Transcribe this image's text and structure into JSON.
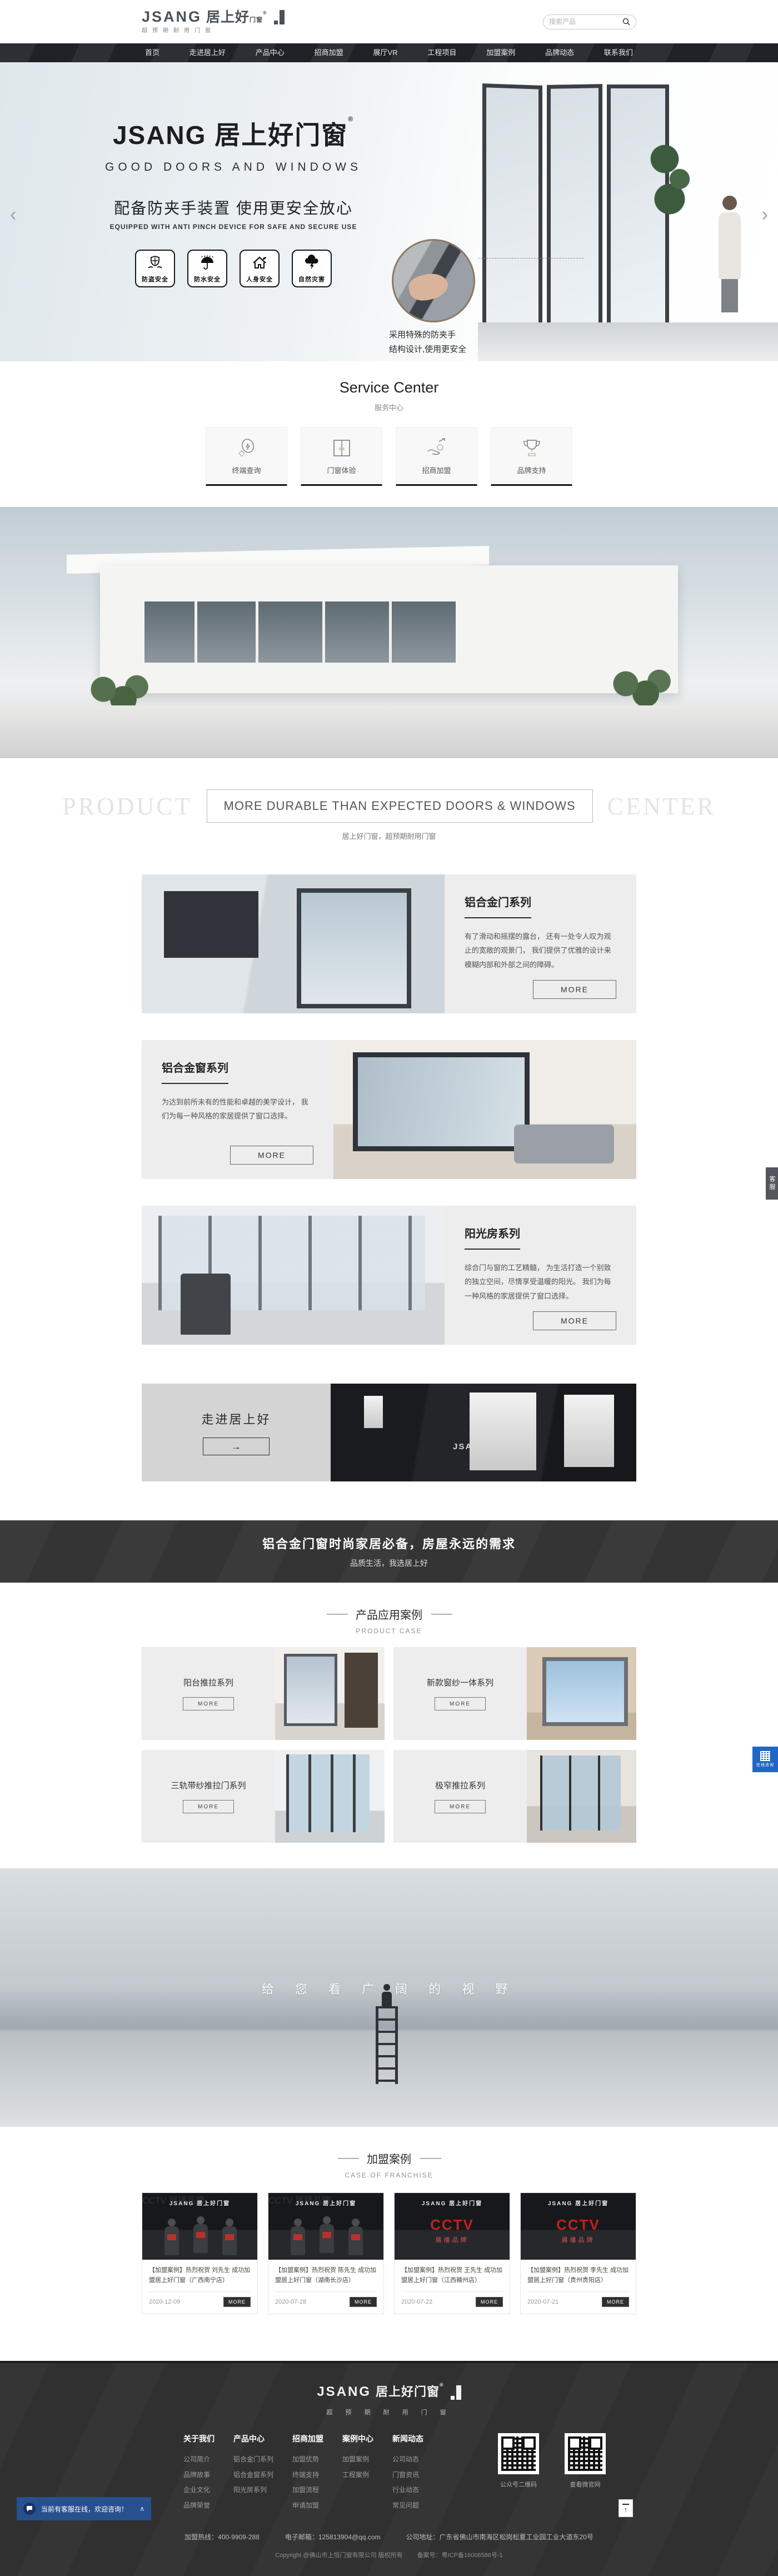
{
  "header": {
    "logo_en": "JSANG",
    "logo_cn": "居上好",
    "logo_suffix": "门窗",
    "logo_reg": "®",
    "tagline": "超预期耐用门窗",
    "search_placeholder": "搜索产品"
  },
  "nav": {
    "items": [
      "首页",
      "走进居上好",
      "产品中心",
      "招商加盟",
      "展厅VR",
      "工程项目",
      "加盟案例",
      "品牌动态",
      "联系我们"
    ]
  },
  "hero": {
    "title_en": "JSANG",
    "title_cn": "居上好门窗",
    "reg": "®",
    "subtitle": "GOOD DOORS AND WINDOWS",
    "slogan": "配备防夹手装置 使用更安全放心",
    "slogan_en": "EQUIPPED WITH ANTI PINCH DEVICE FOR SAFE AND SECURE USE",
    "badges": [
      {
        "label": "防盗安全"
      },
      {
        "label": "防水安全"
      },
      {
        "label": "人身安全"
      },
      {
        "label": "自然灾害"
      }
    ],
    "inset_caption_line1": "采用特殊的防夹手",
    "inset_caption_line2": "结构设计,使用更安全",
    "prev": "‹",
    "next": "›"
  },
  "service": {
    "title": "Service Center",
    "subtitle": "服务中心",
    "items": [
      {
        "label": "终端查询"
      },
      {
        "label": "门窗体验"
      },
      {
        "label": "招商加盟"
      },
      {
        "label": "品牌支持"
      }
    ]
  },
  "product_center": {
    "watermark_left": "PRODUCT",
    "watermark_right": "CENTER",
    "boxed_title": "MORE DURABLE THAN EXPECTED DOORS & WINDOWS",
    "subtitle": "居上好门窗，超预期耐用门窗",
    "more_label": "MORE",
    "blocks": [
      {
        "title": "铝合金门系列",
        "desc": "有了滑动和摇摆的露台， 还有一处令人叹为观止的宽敞的观景门， 我们提供了优雅的设计来模糊内部和外部之间的障碍。",
        "row_class": "pblock",
        "img_class": "pimg pimg-1"
      },
      {
        "title": "铝合金窗系列",
        "desc": "为达到前所未有的性能和卓越的美学设计， 我们为每一种风格的家居提供了窗口选择。",
        "row_class": "pblock reverse",
        "img_class": "pimg pimg-2"
      },
      {
        "title": "阳光房系列",
        "desc": "综合门与窗的工艺精髓， 为生活打造一个别致的独立空间，尽情享受温暖的阳光。 我们为每一种风格的家居提供了窗口选择。",
        "row_class": "pblock",
        "img_class": "pimg pimg-3"
      }
    ]
  },
  "showroom": {
    "title": "走进居上好",
    "arrow": "→",
    "brand_text": "JSANG 居上好门窗"
  },
  "slogan_band": {
    "line1": "铝合金门窗时尚家居必备，房屋永远的需求",
    "line2": "品质生活，我选居上好"
  },
  "product_case": {
    "dash": "——",
    "title": "产品应用案例",
    "subtitle": "PRODUCT CASE",
    "more_label": "MORE",
    "items": [
      {
        "title": "阳台推拉系列",
        "img_class": "ccard-img cimg-1"
      },
      {
        "title": "新款窗纱一体系列",
        "img_class": "ccard-img cimg-2"
      },
      {
        "title": "三轨带纱推拉门系列",
        "img_class": "ccard-img cimg-3"
      },
      {
        "title": "极窄推拉系列",
        "img_class": "ccard-img cimg-4"
      }
    ]
  },
  "vision": {
    "text": "给 您 看 广 阔 的 视 野"
  },
  "franchise": {
    "dash": "——",
    "title": "加盟案例",
    "subtitle": "CASE OF FRANCHISE",
    "more_label": "MORE",
    "brand_text": "JSANG 居上好门窗",
    "cctv": "CCTV",
    "cctv_sub": "展播品牌",
    "items": [
      {
        "title": "【加盟案例】热烈祝贺 刘先生 成功加盟居上好门窗（广西南宁店）",
        "date": "2020-12-09",
        "scene_class": "news-scene scene-people"
      },
      {
        "title": "【加盟案例】热烈祝贺 陈先生 成功加盟居上好门窗（湖南长沙店）",
        "date": "2020-07-28",
        "scene_class": "news-scene scene-people"
      },
      {
        "title": "【加盟案例】热烈祝贺 王先生 成功加盟居上好门窗（江西赣州店）",
        "date": "2020-07-22",
        "scene_class": "news-scene scene-cctv"
      },
      {
        "title": "【加盟案例】热烈祝贺 李先生 成功加盟居上好门窗（贵州贵阳店）",
        "date": "2020-07-21",
        "scene_class": "news-scene scene-cctv"
      }
    ]
  },
  "footer": {
    "logo_en": "JSANG",
    "logo_cn": "居上好门窗",
    "logo_reg": "®",
    "tagline": "超 预 期 耐 用 门 窗",
    "columns": [
      {
        "title": "关于我们",
        "links": [
          "公司简介",
          "品牌故事",
          "企业文化",
          "品牌荣誉"
        ]
      },
      {
        "title": "产品中心",
        "links": [
          "铝合金门系列",
          "铝合金窗系列",
          "阳光房系列"
        ]
      },
      {
        "title": "招商加盟",
        "links": [
          "加盟优势",
          "终端支持",
          "加盟流程",
          "申请加盟"
        ]
      },
      {
        "title": "案例中心",
        "links": [
          "加盟案例",
          "工程案例"
        ]
      },
      {
        "title": "新闻动态",
        "links": [
          "公司动态",
          "门窗资讯",
          "行业动态",
          "常见问题"
        ]
      }
    ],
    "qrcodes": [
      {
        "label": "公众号二维码"
      },
      {
        "label": "查看微官网"
      }
    ],
    "hotline": "加盟热线：400-9909-288",
    "email": "电子邮箱：125813904@qq.com",
    "address": "公司地址：广东省佛山市南海区松岗松夏工业园工业大道东20号",
    "copyright": "Copyright @佛山市上恒门窗有限公司 版权所有",
    "icp": "备案号：粤ICP备16006586号-1"
  },
  "floating": {
    "chat_text": "当前有客服在线，欢迎咨询！",
    "collapse": "∧",
    "side_tab": "客服",
    "consult_label": "在线咨询",
    "back_top": "↑"
  }
}
